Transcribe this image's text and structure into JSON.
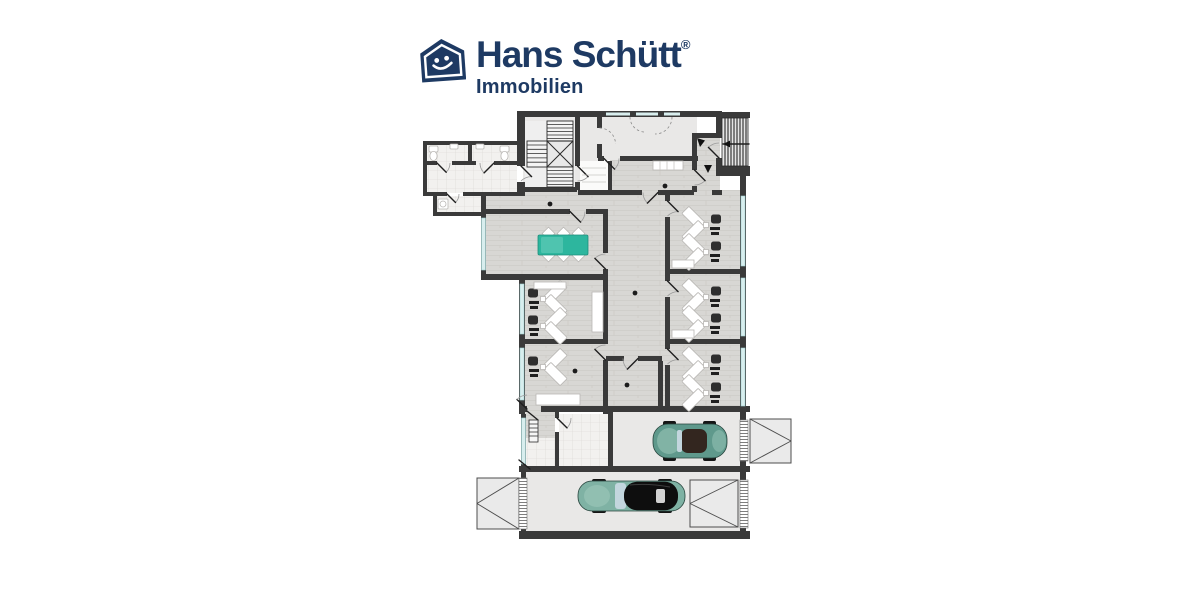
{
  "logo": {
    "brand": "Hans Schütt",
    "registered": "®",
    "subtitle": "Immobilien",
    "icon": "house-smiley-icon"
  },
  "colors": {
    "brand": "#1e3a63",
    "wall": "#3a3a3a",
    "wood": "#d8d7d4",
    "wood-line": "#c9c7c2",
    "plain": "#e9e8e7",
    "tile": "#f2f1ef",
    "tile-line": "#d9d7d3",
    "window": "#d8eeee",
    "window-line": "#a2d2d3",
    "table": "#2db69e",
    "table-light": "#63ccb9",
    "car-body": "#5f998c",
    "car-body2": "#7fb2a4",
    "car-light": "#9cc8ba",
    "furniture": "#ffffff",
    "furniture-line": "#b9b7b4"
  },
  "floorplan": {
    "type": "office-floor-plan-with-garage",
    "office_rooms_right": 3,
    "office_rooms_left": 2,
    "workstations": 9,
    "conference_table": 1,
    "cars_in_garage": 2,
    "garage_lanes": 2,
    "stairwells": 2,
    "wc_rooms": 2
  }
}
